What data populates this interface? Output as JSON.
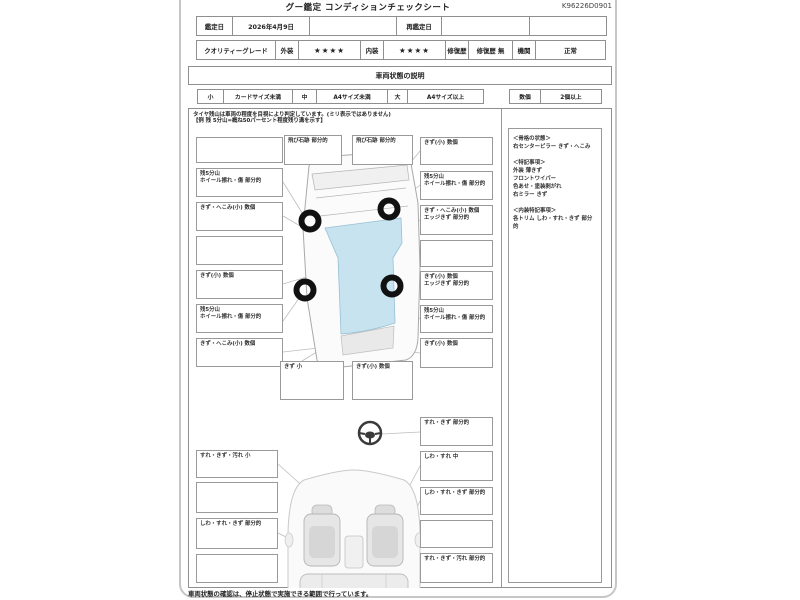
{
  "page": {
    "title": "グー鑑定 コンディションチェックシート",
    "sheet_code": "K96226D0901",
    "footer_note": "車両状態の確認は、停止状態で実施できる範囲で行っています。"
  },
  "appraisal": {
    "date_label": "鑑定日",
    "date_value": "2026年4月9日",
    "redate_label": "再鑑定日",
    "redate_value": "",
    "grade_label": "クオリティーグレード",
    "exterior_label": "外装",
    "exterior_stars": "★★★★",
    "interior_label": "内装",
    "interior_stars": "★★★★",
    "repair_label": "修復歴",
    "repair_value": "修復歴 無",
    "engine_label": "機関",
    "engine_value": "正常"
  },
  "condition": {
    "section_title": "車両状態の説明",
    "size_small_key": "小",
    "size_small_desc": "カードサイズ未満",
    "size_mid_key": "中",
    "size_mid_desc": "A4サイズ未満",
    "size_large_key": "大",
    "size_large_desc": "A4サイズ以上",
    "count_key": "数個",
    "count_desc": "2個以上",
    "tire_note": "タイヤ残山は車両の程度を目視により判定しています。(ミリ表示ではありません)\n【例 残 5分山=概ね50パーセント程度残り溝を示す】"
  },
  "exterior_callouts": {
    "top": [
      "飛び石跡 部分的",
      "飛び石跡 部分的"
    ],
    "left": [
      "",
      "残5分山\nホイール擦れ・傷 部分的",
      "きず・へこみ(小) 数個",
      "",
      "きず(小) 数個",
      "残5分山\nホイール擦れ・傷 部分的",
      "きず・へこみ(小) 数個"
    ],
    "right": [
      "きず(小) 数個",
      "残5分山\nホイール擦れ・傷 部分的",
      "きず・へこみ(小) 数個\nエッジきず 部分的",
      "",
      "きず(小) 数個\nエッジきず 部分的",
      "残5分山\nホイール擦れ・傷 部分的",
      "きず(小) 数個"
    ],
    "bottom": [
      "きず 小",
      "きず(小) 数個"
    ]
  },
  "interior_callouts": {
    "left": [
      "すれ・きず・汚れ 小",
      "",
      "しわ・すれ・きず 部分的",
      ""
    ],
    "right": [
      "すれ・きず 部分的",
      "しわ・すれ 中",
      "しわ・すれ・きず 部分的",
      "",
      "すれ・きず・汚れ 部分的"
    ]
  },
  "notes_panel": {
    "text": "＜骨格の状態＞\n右センターピラー きず・へこみ\n\n＜特記事項＞\n外装 薄きず\nフロントワイパー\n色あせ・塗装剥がれ\n右ミラー きず\n\n＜内装特記事項＞\n各トリム しわ・すれ・きず 部分的"
  },
  "colors": {
    "glass_blue": "#c7e3ef",
    "frame_gray": "#c6c6c6",
    "wheel_black": "#111111"
  }
}
